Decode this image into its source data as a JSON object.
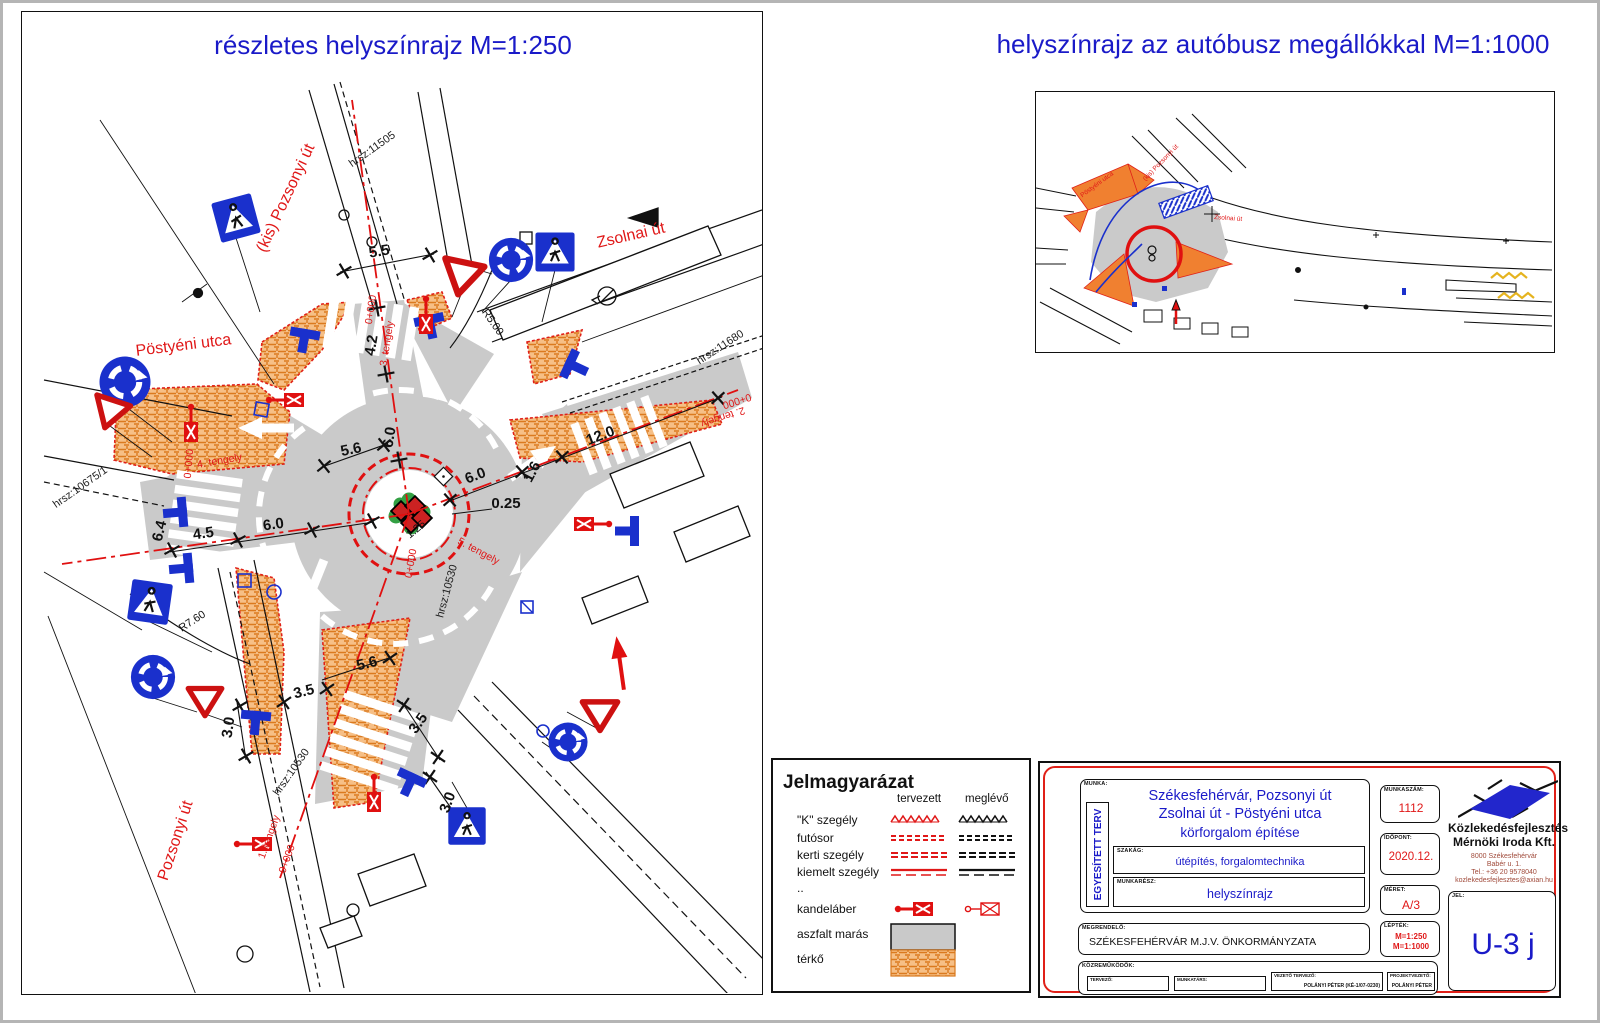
{
  "titles": {
    "left": "részletes helyszínrajz M=1:250",
    "right": "helyszínrajz az autóbusz megállókkal M=1:1000"
  },
  "main_plan": {
    "streets": {
      "kis_pozsonyi": "(kis) Pozsonyi út",
      "zsolnai": "Zsolnai út",
      "postyeni": "Pöstyéni utca",
      "pozsonyi": "Pozsonyi út"
    },
    "parcels": {
      "p11505": "hrsz:11505",
      "p11680": "hrsz:11680",
      "p10675": "hrsz:10675/1",
      "p10530": "hrsz:10530"
    },
    "axes": {
      "a1": "1. tengely",
      "a2": "2. tengely",
      "a3": "3. tengely",
      "a4": "4. tengely",
      "a5": "5. tengely",
      "chainage": "0+000"
    },
    "dims": {
      "d55": "5.5",
      "d42": "4.2",
      "d60": "6.0",
      "d56": "5.6",
      "d64": "6.4",
      "d45": "4.5",
      "d120": "12.0",
      "d025": "0.25",
      "d125": "1.25",
      "d16": "1.6",
      "d35": "3.5",
      "d30": "3.0",
      "r500": "R5.00",
      "r760": "R7.60"
    }
  },
  "overview_map": {
    "streets": {
      "kis_pozsonyi": "(kis) Pozsonyi út",
      "postyeni": "Pöstyéni utca",
      "zsolnai": "Zsolnai út"
    }
  },
  "legend": {
    "title": "Jelmagyarázat",
    "col_planned": "tervezett",
    "col_existing": "meglévő",
    "items": [
      {
        "label": "\"K\" szegély"
      },
      {
        "label": "futósor"
      },
      {
        "label": "kerti szegély"
      },
      {
        "label": "kiemelt szegély"
      },
      {
        "label": ".."
      },
      {
        "label": "kandeláber"
      },
      {
        "label": "aszfalt marás"
      },
      {
        "label": "térkő"
      }
    ]
  },
  "title_block": {
    "munka_label": "MUNKA:",
    "munka_value": "EGYESÍTETT TERV",
    "project_line1": "Székesfehérvár, Pozsonyi út",
    "project_line2": "Zsolnai út - Pöstyéni utca",
    "project_line3": "körforgalom építése",
    "szakag_label": "SZAKÁG:",
    "szakag_value": "útépítés, forgalomtechnika",
    "munkaresz_label": "MUNKARÉSZ:",
    "munkaresz_value": "helyszínrajz",
    "megrendelo_label": "MEGRENDELŐ:",
    "megrendelo_value": "SZÉKESFEHÉRVÁR M.J.V. ÖNKORMÁNYZATA",
    "kozremukodok_label": "KÖZREMŰKÖDŐK:",
    "contributors": [
      {
        "label": "TERVEZŐ:",
        "value": ""
      },
      {
        "label": "MUNKATÁRS:",
        "value": ""
      },
      {
        "label": "VEZETŐ TERVEZŐ:",
        "value": "POLÁNYI PÉTER (KÉ-1/07-0230)"
      },
      {
        "label": "PROJEKTVEZETŐ:",
        "value": "POLÁNYI PÉTER"
      }
    ],
    "munkaszam_label": "MUNKASZÁM:",
    "munkaszam_value": "1112",
    "idopont_label": "IDŐPONT:",
    "idopont_value": "2020.12.",
    "meret_label": "MÉRET:",
    "meret_value": "A/3",
    "leptek_label": "LÉPTÉK:",
    "leptek_value1": "M=1:250",
    "leptek_value2": "M=1:1000",
    "jel_label": "JEL:",
    "jel_value": "U-3 j",
    "company_name1": "Közlekedésfejlesztés",
    "company_name2": "Mérnöki Iroda Kft.",
    "company_addr1": "8000 Székesfehérvár",
    "company_addr2": "Babér u. 1.",
    "company_addr3": "Tel.: +36 20 9578040",
    "company_email": "kozlekedesfejlesztes@axian.hu"
  },
  "colors": {
    "accent_blue": "#1a1ac8",
    "accent_red": "#e01818",
    "sign_blue": "#1a30cc",
    "paving_orange": "#f0a050",
    "asphalt_gray": "#cacaca"
  }
}
